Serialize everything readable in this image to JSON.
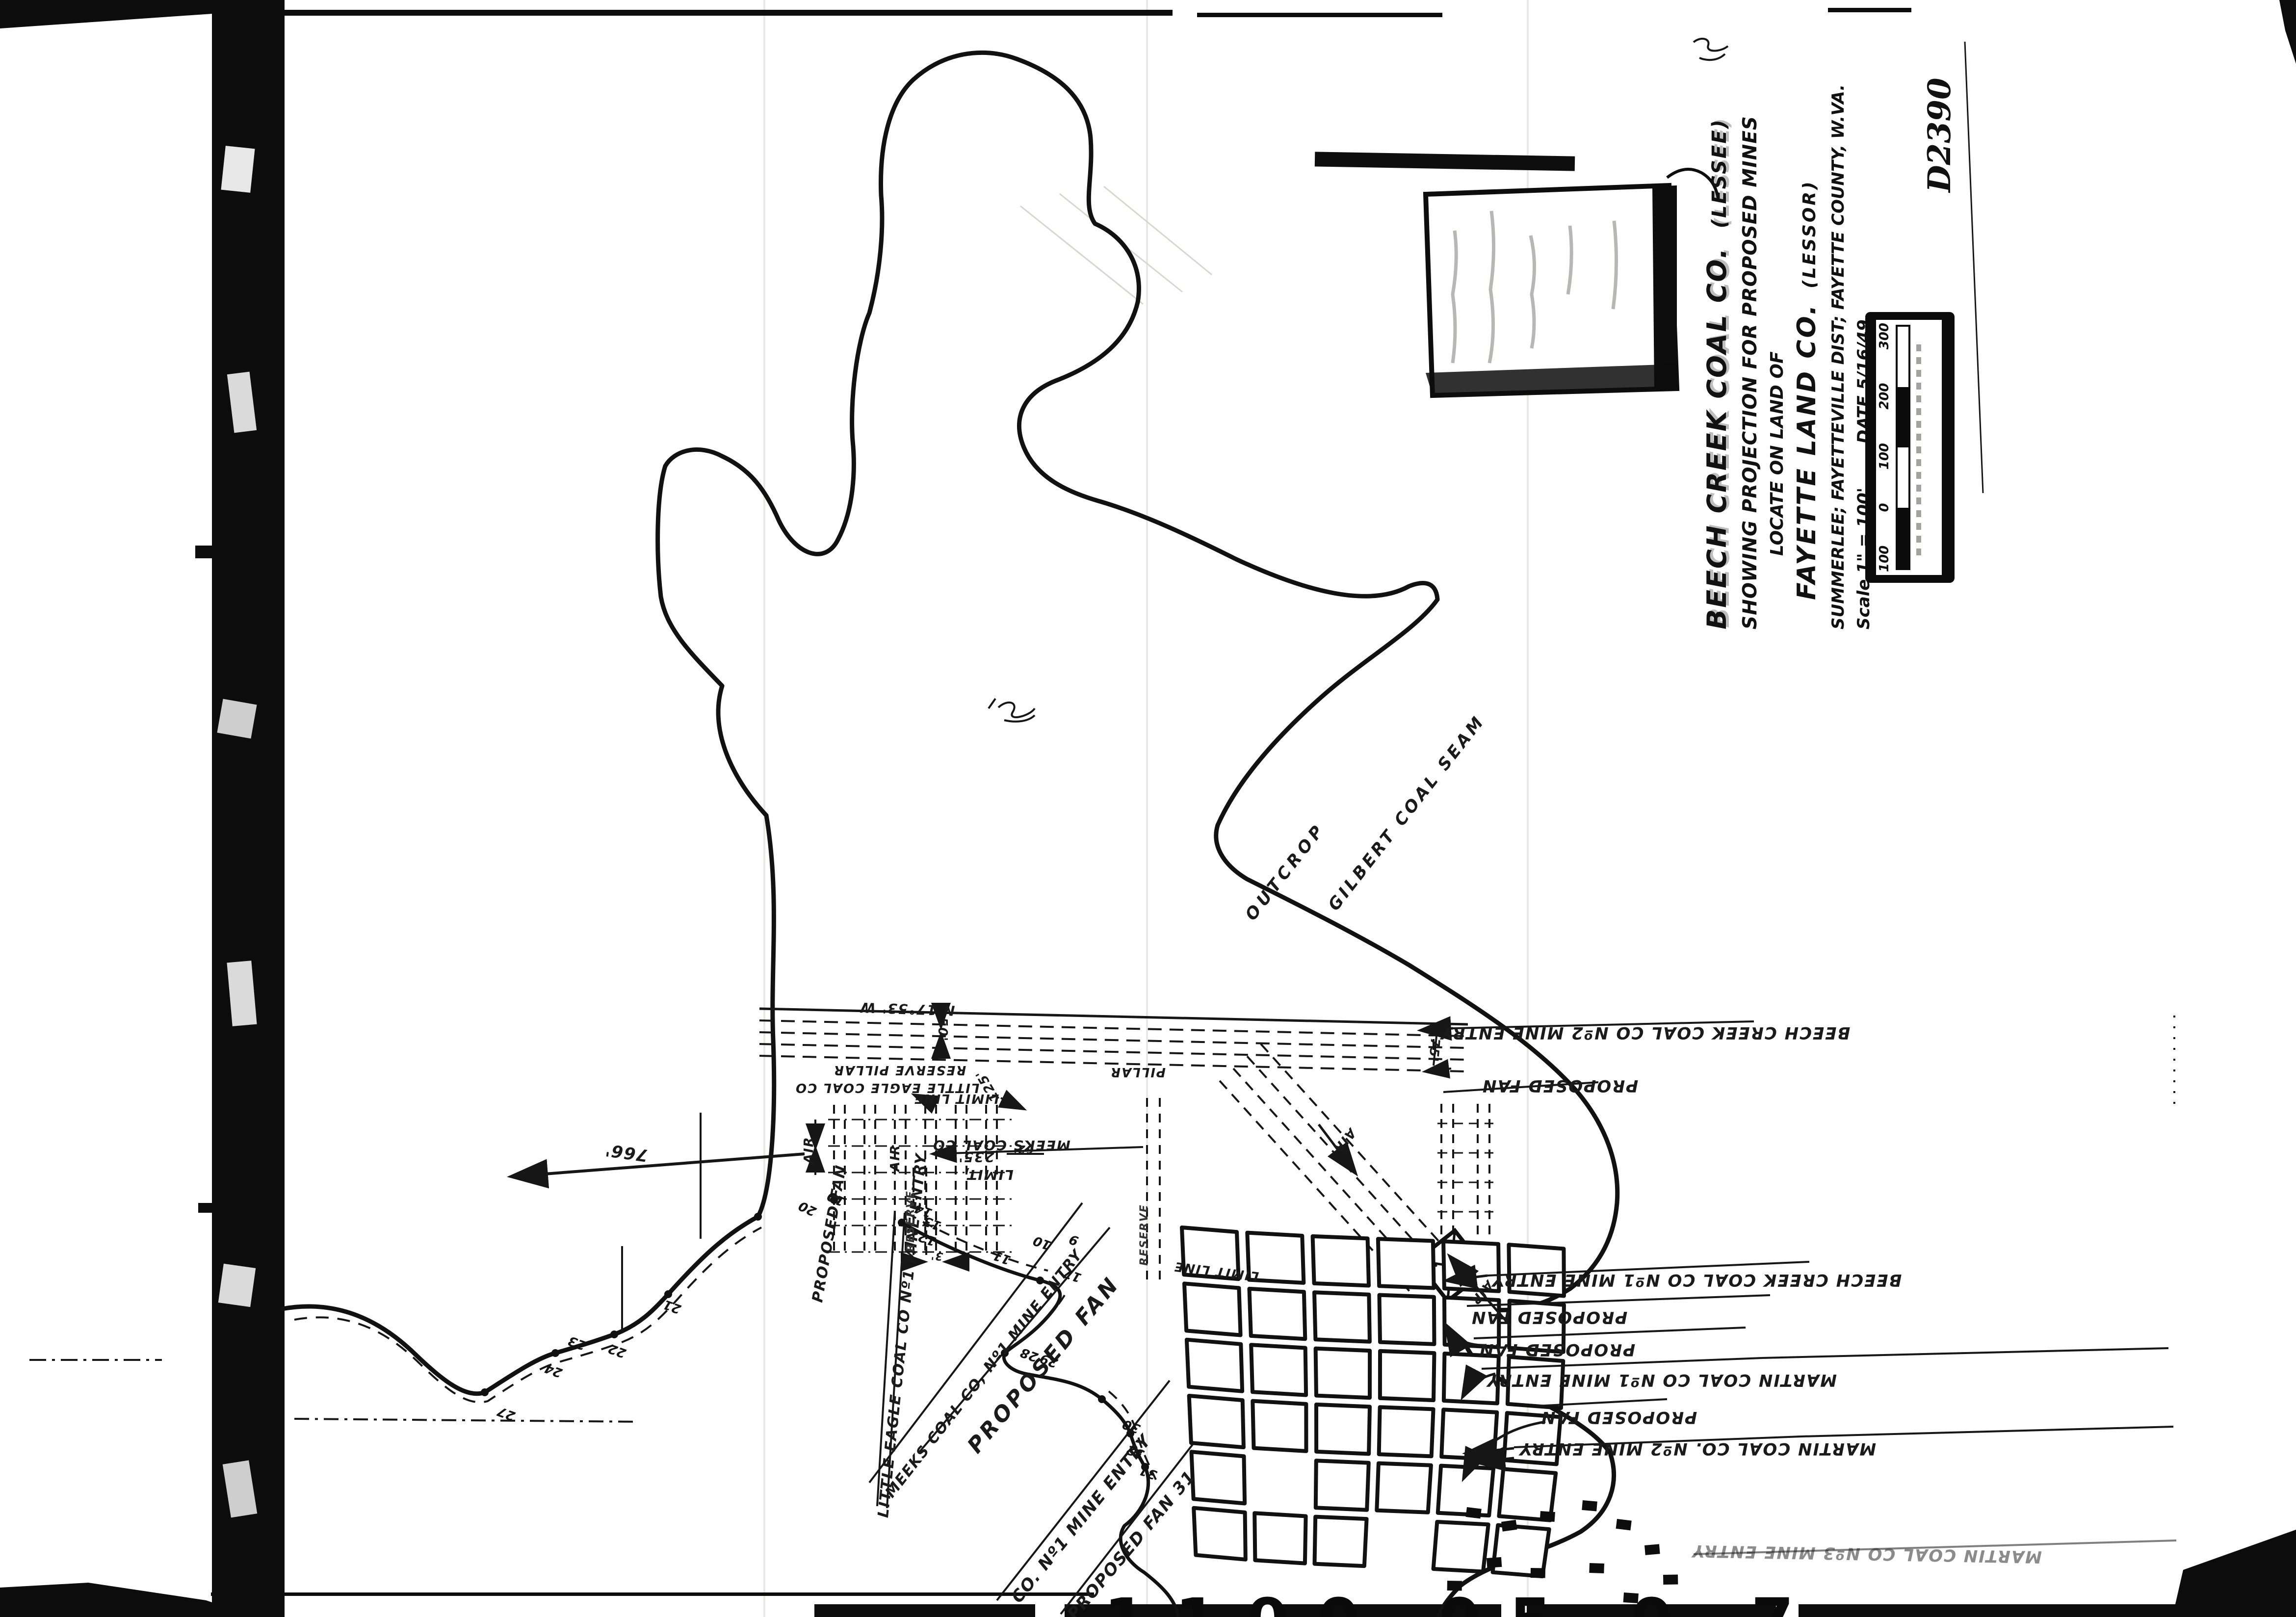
{
  "ink": "#161616",
  "paper": "#ffffff",
  "drawing_number": "D2390",
  "title_block": {
    "company": "BEECH CREEK COAL CO.",
    "company_role": "(LESSEE)",
    "subtitle": "SHOWING PROJECTION FOR PROPOSED MINES",
    "locate": "LOCATE ON LAND OF",
    "landowner": "FAYETTE LAND CO.",
    "landowner_role": "(LESSOR)",
    "location": "SUMMERLEE; FAYETTEVILLE DIST; FAYETTE COUNTY, W.VA.",
    "scale": "Scale 1\" = 100'",
    "date": "DATE 5/16/49"
  },
  "scale_bar": {
    "ticks": [
      "100",
      "0",
      "100",
      "200",
      "300"
    ]
  },
  "outcrop": {
    "word1": "OUTCROP",
    "word2": "GILBERT COAL SEAM"
  },
  "entries": {
    "bearing": "N 17°53' W",
    "spacing": "50'",
    "beech2": "BEECH CREEK COAL CO Nº2 MINE ENTRY",
    "beech1": "BEECH CREEK COAL CO Nº1 MINE ENTRY",
    "martin1": "MARTIN COAL CO Nº1 MINE ENTRY",
    "martin2": "MARTIN COAL CO. Nº2 MINE ENTRY",
    "martin3": "MARTIN COAL CO Nº3 MINE ENTRY",
    "little_eagle1": "LITTLE EAGLE COAL CO  Nº1 MINE ENTRY",
    "meeks1": "MEEKS COAL CO, Nº1 MINE ENTRY",
    "co1": "CO.  Nº1 MINE ENTRY",
    "proposed_fan": "PROPOSED FAN",
    "fan_point": "PROPOSED FAN 31"
  },
  "workings": {
    "reserve_pillar": "RESERVE PILLAR",
    "reserve": "RESERVE",
    "little_eagle": "LITTLE EAGLE COAL CO",
    "meeks": "MEEKS COAL CO",
    "pillar": "PILLAR",
    "limit_line": "LIMIT LINE",
    "limit_word": "LIMIT,",
    "air": "AIR",
    "d235": "235'",
    "d125": "125'",
    "d62": "62'",
    "d75": "75'",
    "d3": "3'",
    "d766": "766'"
  },
  "points": {
    "p9": "9",
    "p10": "10",
    "p11": "11",
    "p12": "12",
    "p13": "13",
    "p14": "14",
    "p17": "17",
    "p19": "19",
    "p20": "20",
    "p21": "21",
    "p22": "22",
    "p23": "23",
    "p24": "24",
    "p27": "27",
    "p28": "28",
    "p29": "29",
    "p30": "30",
    "p31": "31",
    "p32": "32"
  },
  "bottom_edge": {
    "fragments": "1100 05 0 7"
  }
}
